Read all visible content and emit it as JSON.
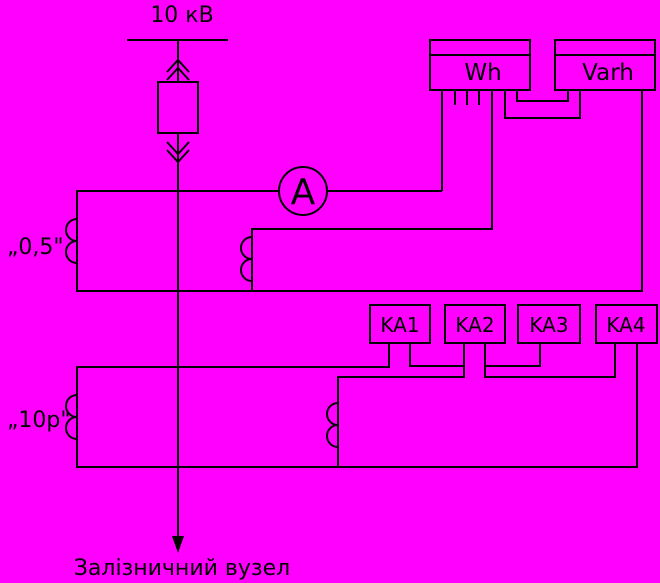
{
  "title": "Схема вимірювальних кіл приєднання 10 кВ",
  "colors": {
    "background": "#ff00ff",
    "line": "#000000",
    "text": "#000000"
  },
  "labels": {
    "busbar_voltage": "10 кВ",
    "wh_meter": "Wh",
    "varh_meter": "Varh",
    "ammeter": "A",
    "ct_class_metering": "„0,5\"",
    "ct_class_protection": "„10р\"",
    "load": "Залізничний вузел"
  },
  "relays": [
    {
      "label": "KA1"
    },
    {
      "label": "KA2"
    },
    {
      "label": "KA3"
    },
    {
      "label": "KA4"
    }
  ]
}
